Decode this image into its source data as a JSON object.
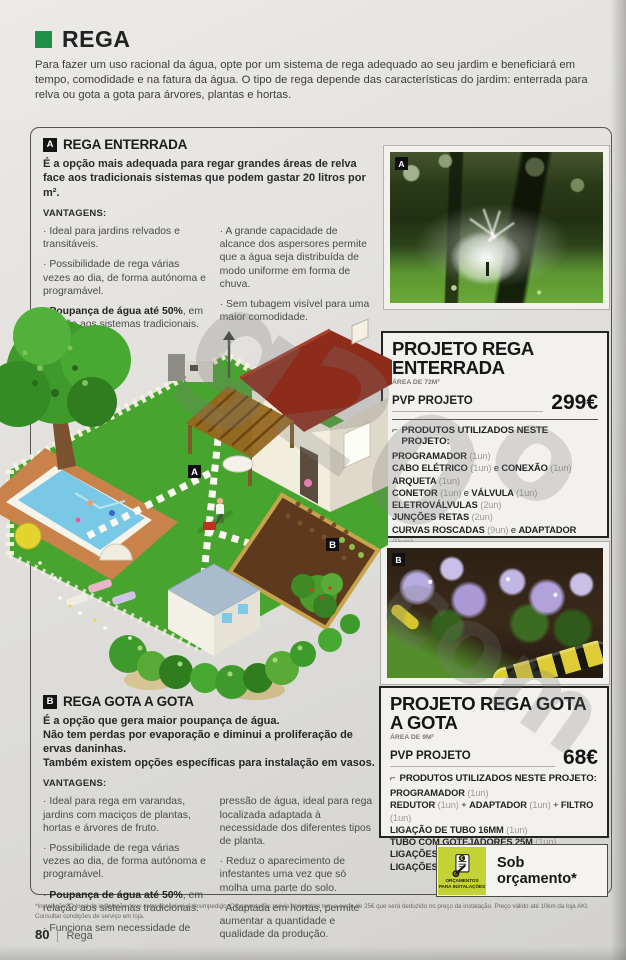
{
  "page": {
    "title": "REGA",
    "intro": "Para fazer um uso racional da água, opte por um sistema de rega adequado ao seu jardim e beneficiará em tempo, comodidade e na fatura da água. O tipo de rega depende das características do jardim: enterrada para relva ou gota a gota para árvores, plantas e hortas.",
    "footnote_line1": "*Instalação: O local da instalação deve estar acessível e desimpedido. Orçamentação prévia obrigatória tem o custo de 25€ que será deduzido no preço da instalação. Preço válido até 10km da loja AKI.",
    "footnote_line2": "Consultar condições de serviço em loja.",
    "page_number": "80",
    "page_section_label": "Rega"
  },
  "watermark": {
    "fragments": [
      "g20",
      "o",
      "com"
    ]
  },
  "colors": {
    "brand_green": "#1f9146",
    "badge_green": "#c3d335",
    "ink": "#262626"
  },
  "section_a": {
    "marker": "A",
    "title": "REGA ENTERRADA",
    "description": "É a opção mais adequada para regar grandes áreas de relva face aos tradicionais sistemas que podem gastar 20 litros por m².",
    "advantages_label": "VANTAGENS:",
    "advantages_left": [
      [
        {
          "t": "· Ideal para jardins relvados e transitáveis.",
          "s": "n"
        }
      ],
      [
        {
          "t": "· Possibilidade de rega várias vezes ao dia, de forma autónoma e programável.",
          "s": "n"
        }
      ],
      [
        {
          "t": "· ",
          "s": "n"
        },
        {
          "t": "Poupança de água até 50%",
          "s": "b"
        },
        {
          "t": ", em relação aos sistemas tradicionais.",
          "s": "n"
        }
      ]
    ],
    "advantages_right": [
      [
        {
          "t": "· A grande capacidade de alcance dos aspersores permite que a água seja distribuída de modo uniforme em forma de chuva.",
          "s": "n"
        }
      ],
      [
        {
          "t": "· Sem tubagem visível para uma maior comodidade.",
          "s": "n"
        }
      ]
    ]
  },
  "section_b": {
    "marker": "B",
    "title": "REGA GOTA A GOTA",
    "description_lines": [
      "É a opção que gera maior poupança de água.",
      "Não tem perdas por evaporação e diminui a proliferação de ervas daninhas.",
      "Também existem opções específicas para instalação em vasos."
    ],
    "advantages_label": "VANTAGENS:",
    "advantages_left": [
      [
        {
          "t": "· Ideal para rega em varandas, jardins com maciços de plantas, hortas e árvores de fruto.",
          "s": "n"
        }
      ],
      [
        {
          "t": "· Possibilidade de rega várias vezes ao dia, de forma autónoma e programável.",
          "s": "n"
        }
      ],
      [
        {
          "t": "· ",
          "s": "n"
        },
        {
          "t": "Poupança de água até 50%",
          "s": "b"
        },
        {
          "t": ", em relação aos sistemas tradicionais.",
          "s": "n"
        }
      ],
      [
        {
          "t": "· Funciona sem necessidade de",
          "s": "n"
        }
      ]
    ],
    "advantages_right": [
      [
        {
          "t": "pressão de água, ideal para rega localizada adaptada à necessidade dos diferentes tipos de planta.",
          "s": "n"
        }
      ],
      [
        {
          "t": "· Reduz o aparecimento de infestantes uma vez que só molha uma parte do solo.",
          "s": "n"
        }
      ],
      [
        {
          "t": "· Adaptada em hortas, permite aumentar a quantidade e qualidade da produção.",
          "s": "n"
        }
      ]
    ]
  },
  "project_a": {
    "title": "PROJETO REGA ENTERRADA",
    "area": "ÁREA DE 72M²",
    "pvp_label": "PVP PROJETO",
    "price": "299€",
    "list_icon": "⌐",
    "products_label": "PRODUTOS UTILIZADOS NESTE PROJETO:",
    "products": [
      [
        {
          "t": "PROGRAMADOR ",
          "s": "b"
        },
        {
          "t": "(1un)",
          "s": "q"
        }
      ],
      [
        {
          "t": "CABO ELÉTRICO ",
          "s": "b"
        },
        {
          "t": "(1un)",
          "s": "q"
        },
        {
          "t": " e ",
          "s": "n"
        },
        {
          "t": "CONEXÃO ",
          "s": "b"
        },
        {
          "t": "(1un)",
          "s": "q"
        }
      ],
      [
        {
          "t": "ARQUETA ",
          "s": "b"
        },
        {
          "t": "(1un)",
          "s": "q"
        }
      ],
      [
        {
          "t": "CONETOR ",
          "s": "b"
        },
        {
          "t": "(1un)",
          "s": "q"
        },
        {
          "t": " e ",
          "s": "n"
        },
        {
          "t": "VÁLVULA ",
          "s": "b"
        },
        {
          "t": "(1un)",
          "s": "q"
        }
      ],
      [
        {
          "t": "ELETROVÁLVULAS ",
          "s": "b"
        },
        {
          "t": "(2un)",
          "s": "q"
        }
      ],
      [
        {
          "t": "JUNÇÕES RETAS ",
          "s": "b"
        },
        {
          "t": "(2un)",
          "s": "q"
        }
      ],
      [
        {
          "t": "CURVAS ROSCADAS ",
          "s": "b"
        },
        {
          "t": "(9un)",
          "s": "q"
        },
        {
          "t": " e ",
          "s": "n"
        },
        {
          "t": "ADAPTADOR ",
          "s": "b"
        },
        {
          "t": "(9un)",
          "s": "q"
        }
      ],
      [
        {
          "t": "TOMADAS EM CARGA ",
          "s": "b"
        },
        {
          "t": "(9un)",
          "s": "q"
        },
        {
          "t": " e ",
          "s": "n"
        },
        {
          "t": "CURVAS ARTICULADAS ",
          "s": "b"
        },
        {
          "t": "(9un)",
          "s": "q"
        }
      ],
      [
        {
          "t": "TUBO DE 25MM-50M ",
          "s": "b"
        },
        {
          "t": "(1un)",
          "s": "q"
        }
      ],
      [
        {
          "t": "LIGAÇÕES T PARA TUBO ",
          "s": "b"
        },
        {
          "t": "(7un)",
          "s": "q"
        }
      ],
      [
        {
          "t": "CURVAS LIGAÇÕES DE TUBO ",
          "s": "b"
        },
        {
          "t": "(4un)",
          "s": "q"
        }
      ]
    ]
  },
  "project_b": {
    "title": "PROJETO REGA GOTA A GOTA",
    "area": "ÁREA DE 9M²",
    "pvp_label": "PVP PROJETO",
    "price": "68€",
    "list_icon": "⌐",
    "products_label": "PRODUTOS UTILIZADOS NESTE PROJETO:",
    "products": [
      [
        {
          "t": "PROGRAMADOR ",
          "s": "b"
        },
        {
          "t": "(1un)",
          "s": "q"
        }
      ],
      [
        {
          "t": "REDUTOR ",
          "s": "b"
        },
        {
          "t": "(1un)",
          "s": "q"
        },
        {
          "t": " + ",
          "s": "n"
        },
        {
          "t": "ADAPTADOR ",
          "s": "b"
        },
        {
          "t": "(1un)",
          "s": "q"
        },
        {
          "t": " + ",
          "s": "n"
        },
        {
          "t": "FILTRO ",
          "s": "b"
        },
        {
          "t": "(1un)",
          "s": "q"
        }
      ],
      [
        {
          "t": "LIGAÇÃO DE TUBO 16MM ",
          "s": "b"
        },
        {
          "t": "(1un)",
          "s": "q"
        }
      ],
      [
        {
          "t": "TUBO COM GOTEJADORES 25M ",
          "s": "b"
        },
        {
          "t": "(1un)",
          "s": "q"
        }
      ],
      [
        {
          "t": "LIGAÇÕES T PARA TUBO 16MM ",
          "s": "b"
        },
        {
          "t": "(8un)",
          "s": "q"
        }
      ],
      [
        {
          "t": "LIGAÇÕES L PARA TUBO 16MM ",
          "s": "b"
        },
        {
          "t": "(6un)",
          "s": "q"
        }
      ]
    ]
  },
  "photos": {
    "sprinkler_marker": "A",
    "flowers_marker": "B"
  },
  "illustration": {
    "marker_a": "A",
    "marker_b": "B"
  },
  "badge": {
    "icon_caption_line1": "ORÇAMENTOS",
    "icon_caption_line2": "PARA INSTALAÇÕES",
    "label": "Sob orçamento*"
  }
}
